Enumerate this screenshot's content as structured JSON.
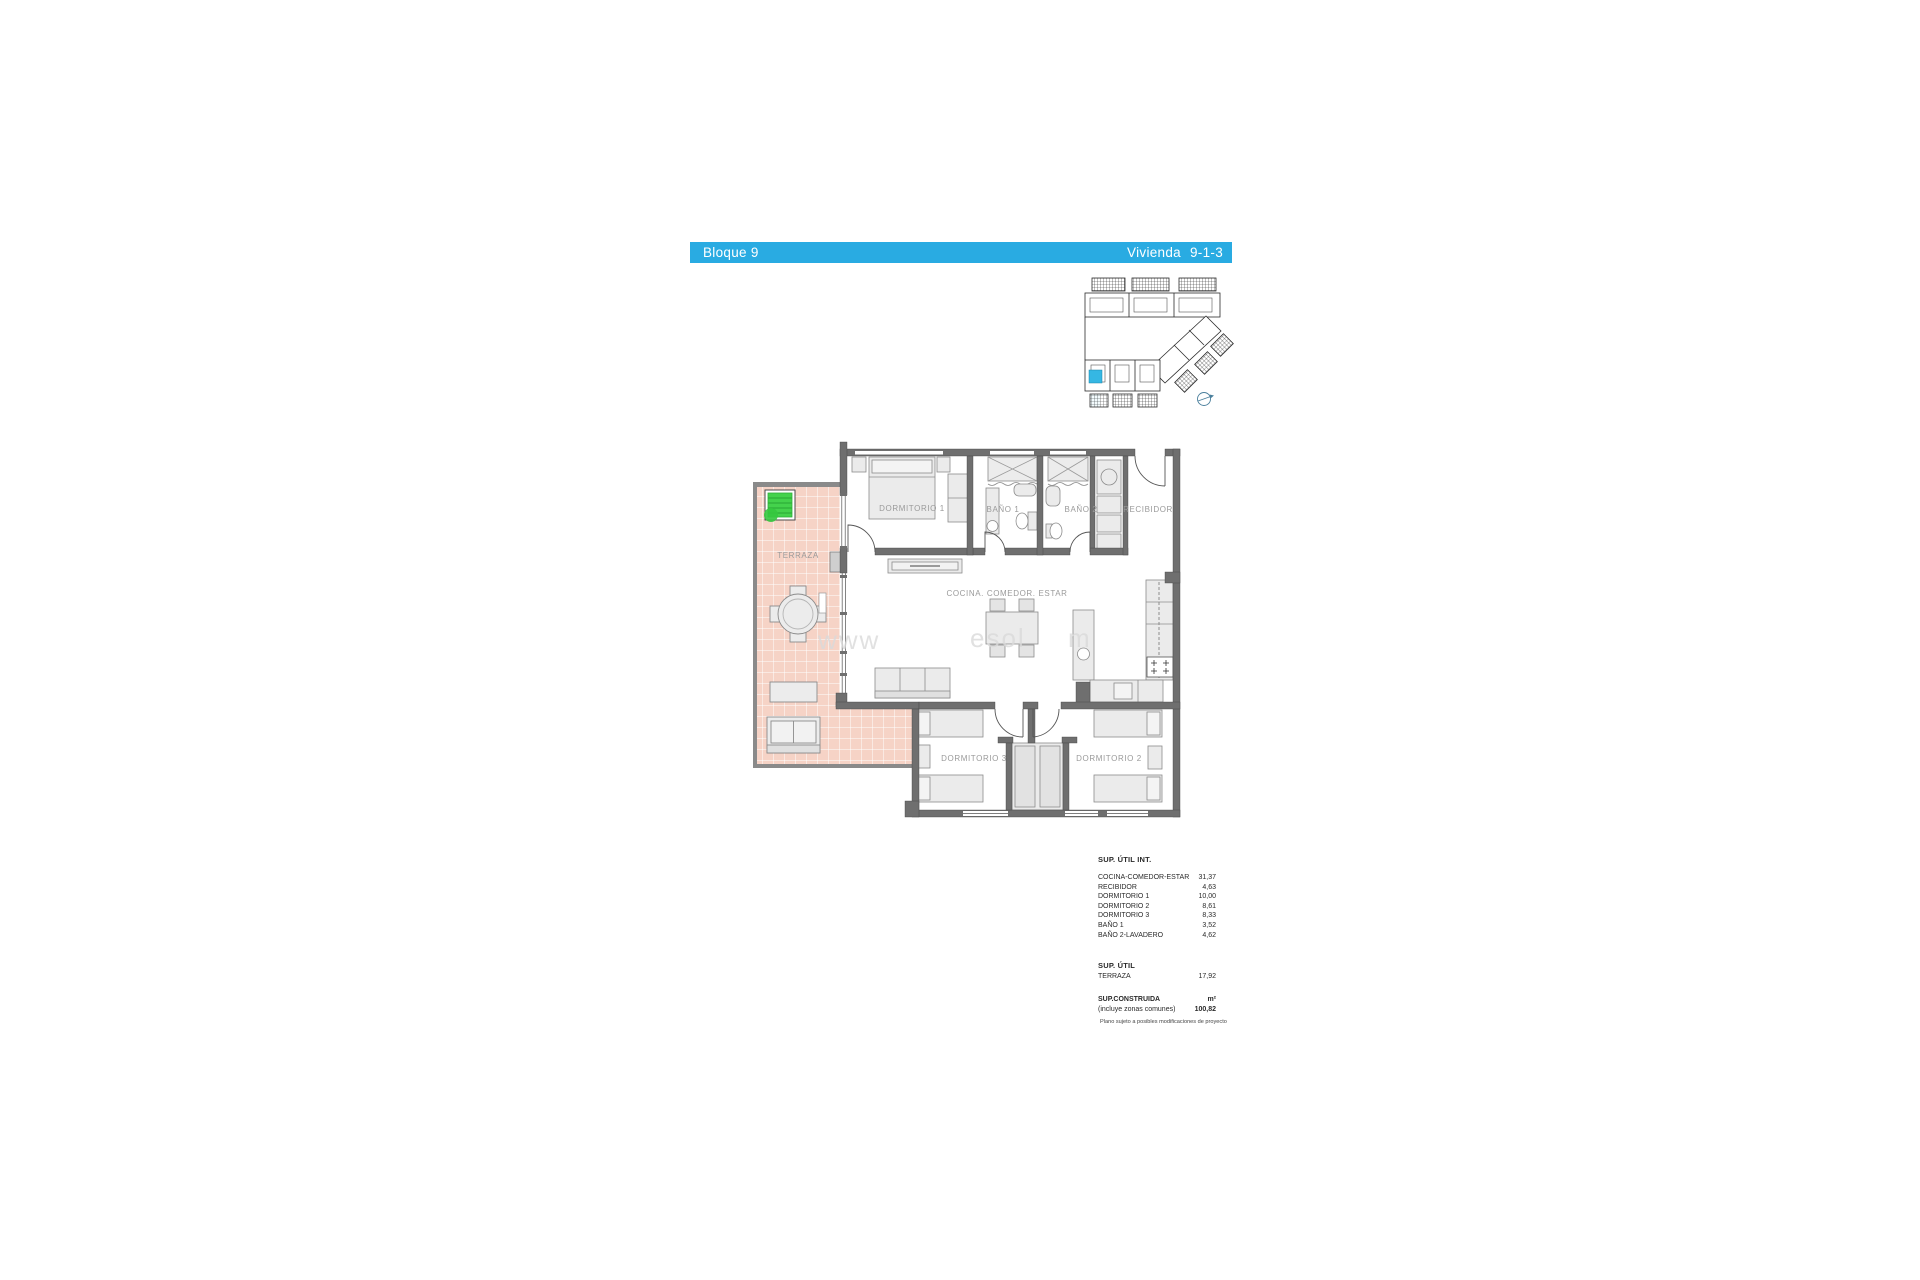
{
  "header": {
    "block": "Bloque 9",
    "dwelling_label": "Vivienda",
    "dwelling_value": "9-1-3"
  },
  "colors": {
    "accent_cyan": "#29abe2",
    "wall_gray": "#6f6f6f",
    "terrace_tile": "#f6d3c6",
    "planter_green": "#3fd049"
  },
  "floor_plan": {
    "rooms": [
      {
        "label": "TERRAZA"
      },
      {
        "label": "DORMITORIO 1"
      },
      {
        "label": "BAÑO 1"
      },
      {
        "label": "BAÑO 2"
      },
      {
        "label": "RECIBIDOR"
      },
      {
        "label": "COCINA. COMEDOR. ESTAR"
      },
      {
        "label": "DORMITORIO 3"
      },
      {
        "label": "DORMITORIO 2"
      }
    ],
    "watermark": {
      "part1": "www",
      "part2": "esol",
      "part3": "m"
    }
  },
  "areas_table": {
    "util_int": {
      "title": "SUP. ÚTIL INT.",
      "rows": [
        {
          "label": "COCINA-COMEDOR-ESTAR",
          "value": "31,37"
        },
        {
          "label": "RECIBIDOR",
          "value": "4,63"
        },
        {
          "label": "DORMITORIO 1",
          "value": "10,00"
        },
        {
          "label": "DORMITORIO 2",
          "value": "8,61"
        },
        {
          "label": "DORMITORIO 3",
          "value": "8,33"
        },
        {
          "label": "BAÑO 1",
          "value": "3,52"
        },
        {
          "label": "BAÑO 2-LAVADERO",
          "value": "4,62"
        }
      ]
    },
    "util": {
      "title": "SUP. ÚTIL",
      "rows": [
        {
          "label": "TERRAZA",
          "value": "17,92"
        }
      ]
    },
    "construida": {
      "title": "SUP.CONSTRUIDA",
      "unit": "m²",
      "note": "(incluye zonas comunes)",
      "value": "100,82"
    },
    "footnote": "Plano sujeto a posibles modificaciones de proyecto"
  }
}
